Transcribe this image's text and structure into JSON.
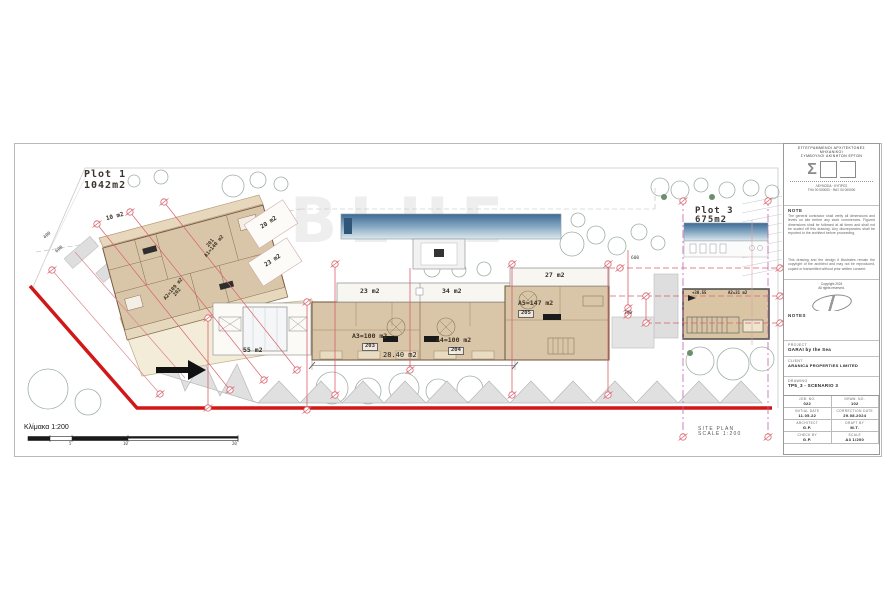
{
  "plan": {
    "watermark": "BLUE",
    "plot1": {
      "name": "Plot 1",
      "area": "1042m2"
    },
    "plot3": {
      "name": "Plot 3",
      "area": "675m2"
    },
    "rooms": {
      "r10": "10 m2",
      "r20": "20 m2",
      "r23a": "23 m2",
      "r23": "23 m2",
      "r34": "34 m2",
      "r27": "27 m2",
      "r55": "55 m2"
    },
    "units": {
      "u201": {
        "no": "201",
        "area": "A1=140 m2"
      },
      "u202": {
        "no": "202",
        "area": "A2=109 m2"
      },
      "u203": {
        "no": "203",
        "area": "A3=100 m2"
      },
      "u204": {
        "no": "204",
        "area": "A4=100 m2"
      },
      "u205": {
        "no": "205",
        "area": "A5=147 m2"
      },
      "annex": {
        "level": "+30.55",
        "area": "A2=31 m2"
      }
    },
    "dims": {
      "building_width": "28.40 m2",
      "d300": "300",
      "d600": "600",
      "road400": "400",
      "road600": "600"
    },
    "scalebar": {
      "label": "Κλίμακα 1:200",
      "t5": "5",
      "t10": "10",
      "t20": "20"
    },
    "caption": {
      "l1": "SITE PLAN",
      "l2": "SCALE 1:200"
    },
    "colors": {
      "boundary_red": "#d11717",
      "dimension_pink": "#d9606c",
      "building_fill": "#d9c6a8",
      "pool_blue": "#3d6a94"
    }
  },
  "titleblock": {
    "firm1": "ΕΓΓΕΓΡΑΜΜΕΝΟΙ ΑΡΧΙΤΕΚΤΟΝΕΣ ΜΗΧΑΝΙΚΟΙ",
    "firm2": "ΣΥΜΒΟΥΛΟΙ ΑΚΙΝΗΤΩΝ ΕΡΓΩΝ",
    "addr1": "ΛΕΥΚΩΣΙΑ · ΚΥΠΡΟΣ",
    "addr2": "ΤΗΛ 00 000000 · ΦΑΞ 00 000000",
    "note_h": "NOTE",
    "note1": "The general contractor shall verify all dimensions and levels on site before any work commences. Figured dimensions shall be followed at all times and shall not be scaled off this drawing. Any discrepancies shall be reported to the architect before proceeding.",
    "note2": "This drawing and the design it illustrates remain the copyright of the architect and may not be reproduced, copied or transmitted without prior written consent.",
    "copy1": "Copyright 2024",
    "copy2": "All rights reserved.",
    "notes_h": "NOTES",
    "project_l": "PROJECT",
    "project_v": "GARAI by the Sea",
    "client_l": "CLIENT",
    "client_v": "ARANICA PROPERTIES LIMITED",
    "drawing_l": "DRAWING",
    "drawing_v": "TP5_3 - SCENARIO 3",
    "table": {
      "r1c1l": "JOB. NO.",
      "r1c1v": "022",
      "r1c2l": "DRAW. NO.",
      "r1c2v": "102",
      "r2c1l": "INITIAL DATE",
      "r2c1v": "11.05.22",
      "r2c2l": "CORRECTION DATE",
      "r2c2v": "29.08.2024",
      "r3c1l": "ARCHITECT",
      "r3c1v": "G.P.",
      "r3c2l": "DRAFT BY",
      "r3c2v": "M.T.",
      "r4c1l": "CHECK BY",
      "r4c1v": "G.P.",
      "r4c2l": "SCALE",
      "r4c2v": "A3 1/200"
    }
  }
}
